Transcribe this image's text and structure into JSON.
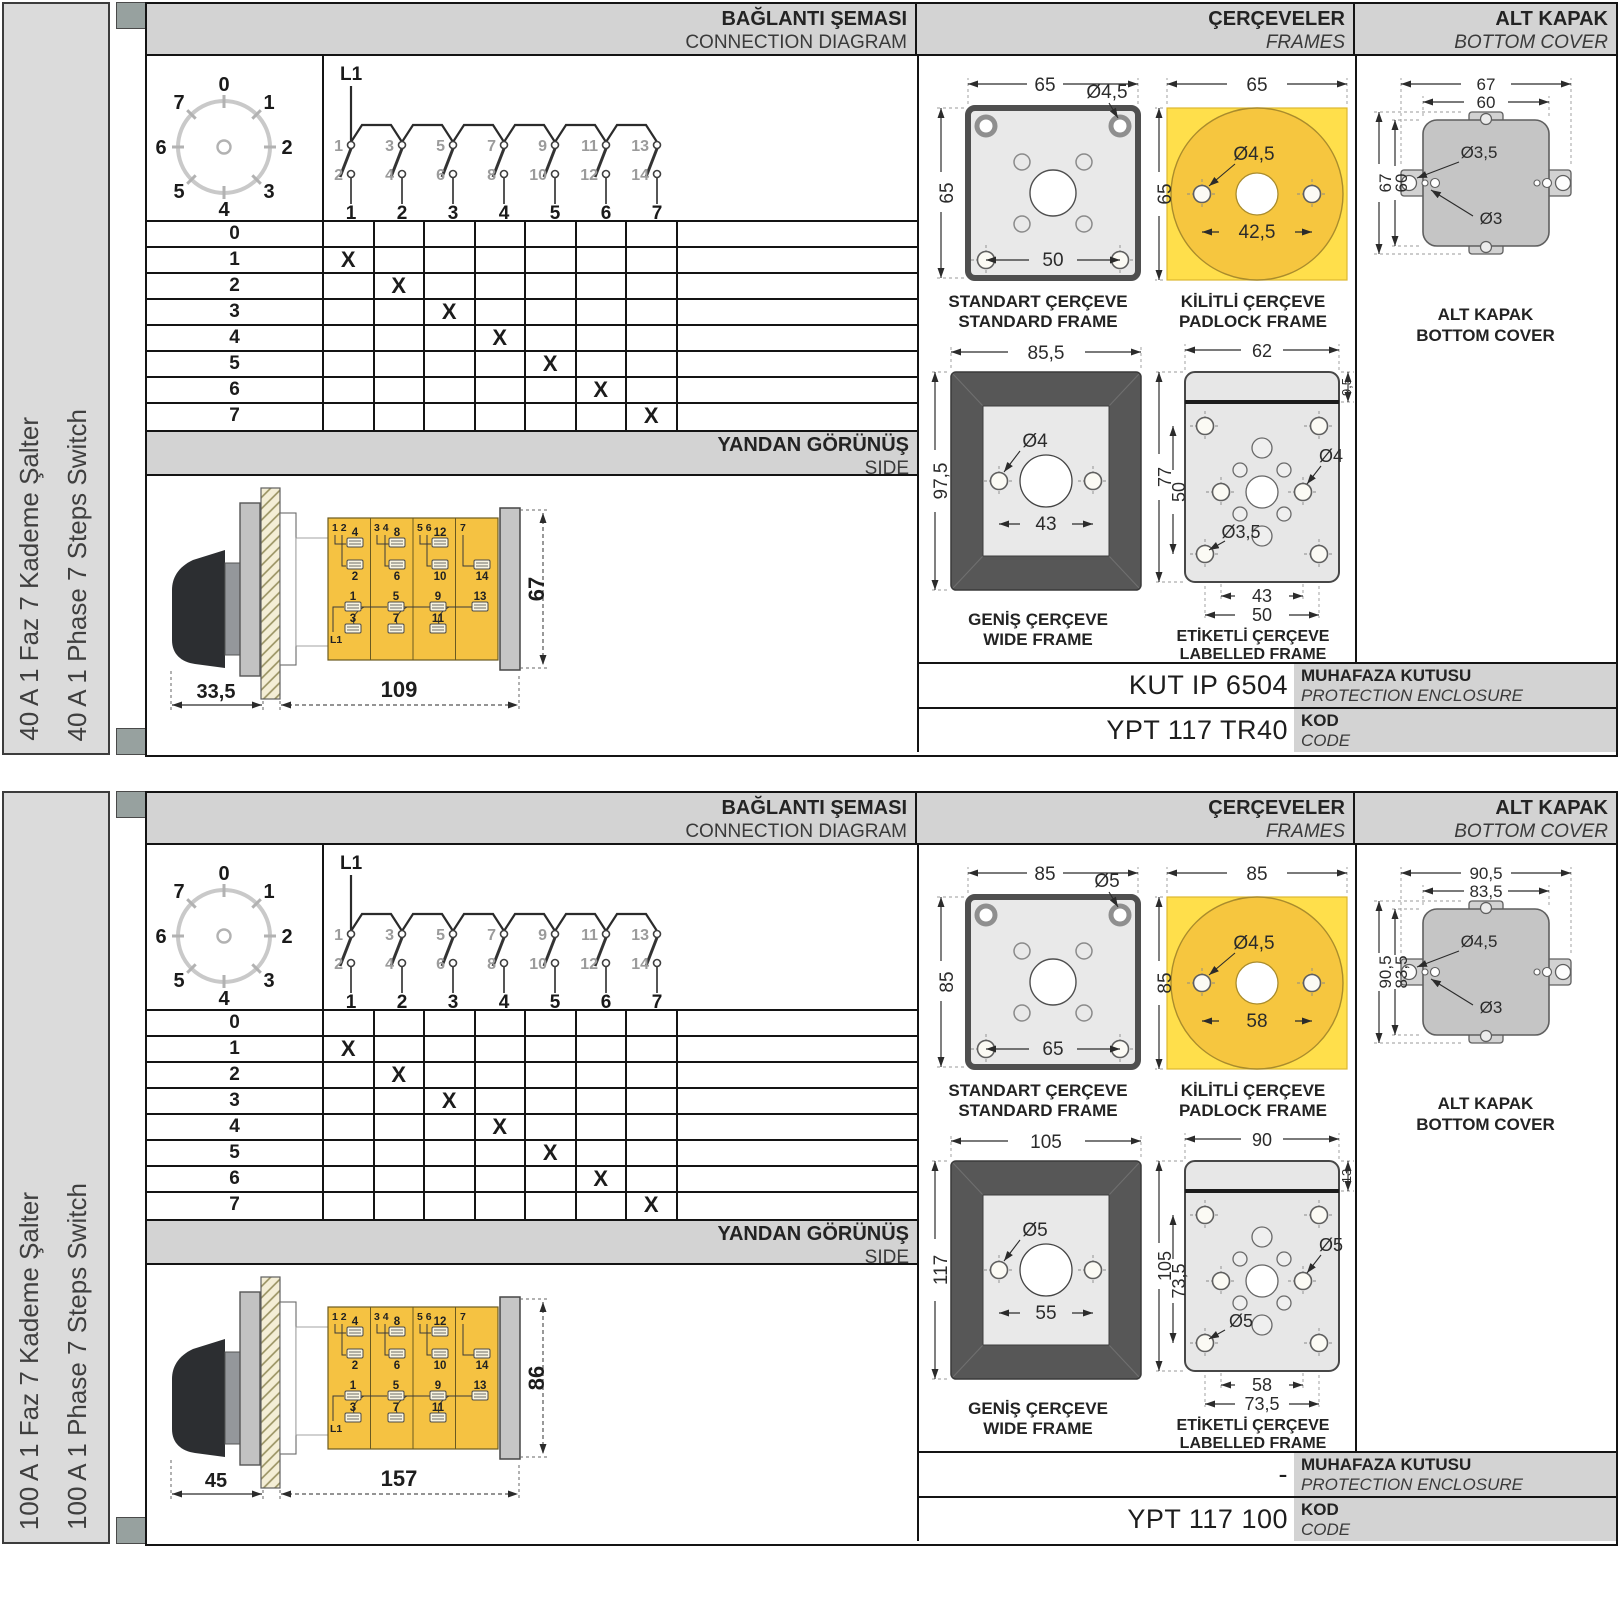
{
  "sections": [
    {
      "sidebar": {
        "title_tr": "40 A 1 Faz 7 Kademe Şalter",
        "title_en": "40 A 1 Phase 7 Steps Switch"
      },
      "headers": {
        "connection_tr": "BAĞLANTI ŞEMASI",
        "connection_en": "CONNECTION DIAGRAM",
        "frames_tr": "ÇERÇEVELER",
        "frames_en": "FRAMES",
        "cover_tr": "ALT KAPAK",
        "cover_en": "BOTTOM COVER"
      },
      "dial": {
        "positions": [
          "0",
          "1",
          "2",
          "3",
          "4",
          "5",
          "6",
          "7"
        ]
      },
      "contacts": {
        "supply": "L1",
        "top_terminals": [
          "1",
          "3",
          "5",
          "7",
          "9",
          "11",
          "13"
        ],
        "bottom_terminals": [
          "2",
          "4",
          "6",
          "8",
          "10",
          "12",
          "14"
        ],
        "outputs": [
          "1",
          "2",
          "3",
          "4",
          "5",
          "6",
          "7"
        ]
      },
      "matrix": {
        "x_mark": "X",
        "rows": [
          {
            "label": "0",
            "x_in_column": null
          },
          {
            "label": "1",
            "x_in_column": 1
          },
          {
            "label": "2",
            "x_in_column": 2
          },
          {
            "label": "3",
            "x_in_column": 3
          },
          {
            "label": "4",
            "x_in_column": 4
          },
          {
            "label": "5",
            "x_in_column": 5
          },
          {
            "label": "6",
            "x_in_column": 6
          },
          {
            "label": "7",
            "x_in_column": 7
          }
        ]
      },
      "side_view": {
        "band_tr": "YANDAN GÖRÜNÜŞ",
        "band_en": "SIDE",
        "dim_handle": "33,5",
        "dim_body": "109",
        "dim_height": "67",
        "supply": "L1",
        "col_top_labels": [
          "1  2",
          "3  4",
          "5  6",
          "7"
        ],
        "upper_terminals": [
          "4",
          "8",
          "12"
        ],
        "mid_terminals": [
          "2",
          "6",
          "10",
          "14"
        ],
        "lower_terminals": [
          "1",
          "5",
          "9",
          "13"
        ],
        "bottom_terminals": [
          "3",
          "7",
          "11"
        ]
      },
      "frames": {
        "standard": {
          "label_tr": "STANDART ÇERÇEVE",
          "label_en": "STANDARD FRAME",
          "dim_width": "65",
          "dim_height": "65",
          "hole": "Ø4,5",
          "dim_spacing": "50"
        },
        "padlock": {
          "label_tr": "KİLİTLİ ÇERÇEVE",
          "label_en": "PADLOCK FRAME",
          "dim_width": "65",
          "dim_height": "65",
          "hole": "Ø4,5",
          "dim_spacing": "42,5"
        },
        "wide": {
          "label_tr": "GENİŞ ÇERÇEVE",
          "label_en": "WIDE FRAME",
          "dim_width": "85,5",
          "dim_height": "97,5",
          "hole": "Ø4",
          "dim_spacing": "43"
        },
        "labelled": {
          "label_tr": "ETİKETLİ ÇERÇEVE",
          "label_en": "LABELLED FRAME",
          "dim_width": "62",
          "dim_strip": "9,5",
          "dim_height": "77",
          "dim_inner_height": "50",
          "hole_right": "Ø4",
          "hole_left": "Ø3,5",
          "dim_spacing_inner": "43",
          "dim_spacing_outer": "50"
        }
      },
      "bottom_cover": {
        "label_tr": "ALT KAPAK",
        "label_en": "BOTTOM COVER",
        "dim_outer_w": "67",
        "dim_inner_w": "60",
        "dim_outer_h": "67",
        "dim_inner_h": "60",
        "hole_tab": "Ø3,5",
        "hole_small": "Ø3"
      },
      "codes": {
        "enclosure_value": "KUT IP 6504",
        "enclosure_label_tr": "MUHAFAZA KUTUSU",
        "enclosure_label_en": "PROTECTION ENCLOSURE",
        "code_value": "YPT 117 TR40",
        "code_label_tr": "KOD",
        "code_label_en": "CODE"
      }
    },
    {
      "sidebar": {
        "title_tr": "100 A 1 Faz 7 Kademe Şalter",
        "title_en": "100 A 1 Phase 7 Steps Switch"
      },
      "headers": {
        "connection_tr": "BAĞLANTI ŞEMASI",
        "connection_en": "CONNECTION DIAGRAM",
        "frames_tr": "ÇERÇEVELER",
        "frames_en": "FRAMES",
        "cover_tr": "ALT KAPAK",
        "cover_en": "BOTTOM COVER"
      },
      "dial": {
        "positions": [
          "0",
          "1",
          "2",
          "3",
          "4",
          "5",
          "6",
          "7"
        ]
      },
      "contacts": {
        "supply": "L1",
        "top_terminals": [
          "1",
          "3",
          "5",
          "7",
          "9",
          "11",
          "13"
        ],
        "bottom_terminals": [
          "2",
          "4",
          "6",
          "8",
          "10",
          "12",
          "14"
        ],
        "outputs": [
          "1",
          "2",
          "3",
          "4",
          "5",
          "6",
          "7"
        ]
      },
      "matrix": {
        "x_mark": "X",
        "rows": [
          {
            "label": "0",
            "x_in_column": null
          },
          {
            "label": "1",
            "x_in_column": 1
          },
          {
            "label": "2",
            "x_in_column": 2
          },
          {
            "label": "3",
            "x_in_column": 3
          },
          {
            "label": "4",
            "x_in_column": 4
          },
          {
            "label": "5",
            "x_in_column": 5
          },
          {
            "label": "6",
            "x_in_column": 6
          },
          {
            "label": "7",
            "x_in_column": 7
          }
        ]
      },
      "side_view": {
        "band_tr": "YANDAN GÖRÜNÜŞ",
        "band_en": "SIDE",
        "dim_handle": "45",
        "dim_body": "157",
        "dim_height": "86",
        "supply": "L1",
        "col_top_labels": [
          "1  2",
          "3  4",
          "5  6",
          "7"
        ],
        "upper_terminals": [
          "4",
          "8",
          "12"
        ],
        "mid_terminals": [
          "2",
          "6",
          "10",
          "14"
        ],
        "lower_terminals": [
          "1",
          "5",
          "9",
          "13"
        ],
        "bottom_terminals": [
          "3",
          "7",
          "11"
        ]
      },
      "frames": {
        "standard": {
          "label_tr": "STANDART ÇERÇEVE",
          "label_en": "STANDARD FRAME",
          "dim_width": "85",
          "dim_height": "85",
          "hole": "Ø5",
          "dim_spacing": "65"
        },
        "padlock": {
          "label_tr": "KİLİTLİ ÇERÇEVE",
          "label_en": "PADLOCK FRAME",
          "dim_width": "85",
          "dim_height": "85",
          "hole": "Ø4,5",
          "dim_spacing": "58"
        },
        "wide": {
          "label_tr": "GENİŞ ÇERÇEVE",
          "label_en": "WIDE FRAME",
          "dim_width": "105",
          "dim_height": "117",
          "hole": "Ø5",
          "dim_spacing": "55"
        },
        "labelled": {
          "label_tr": "ETİKETLİ ÇERÇEVE",
          "label_en": "LABELLED FRAME",
          "dim_width": "90",
          "dim_strip": "13",
          "dim_height": "105",
          "dim_inner_height": "73,5",
          "hole_right": "Ø5",
          "hole_left": "Ø5",
          "dim_spacing_inner": "58",
          "dim_spacing_outer": "73,5"
        }
      },
      "bottom_cover": {
        "label_tr": "ALT KAPAK",
        "label_en": "BOTTOM COVER",
        "dim_outer_w": "90,5",
        "dim_inner_w": "83,5",
        "dim_outer_h": "90,5",
        "dim_inner_h": "83,5",
        "hole_tab": "Ø4,5",
        "hole_small": "Ø3"
      },
      "codes": {
        "enclosure_value": "-",
        "enclosure_label_tr": "MUHAFAZA KUTUSU",
        "enclosure_label_en": "PROTECTION ENCLOSURE",
        "code_value": "YPT 117 100",
        "code_label_tr": "KOD",
        "code_label_en": "CODE"
      }
    }
  ]
}
